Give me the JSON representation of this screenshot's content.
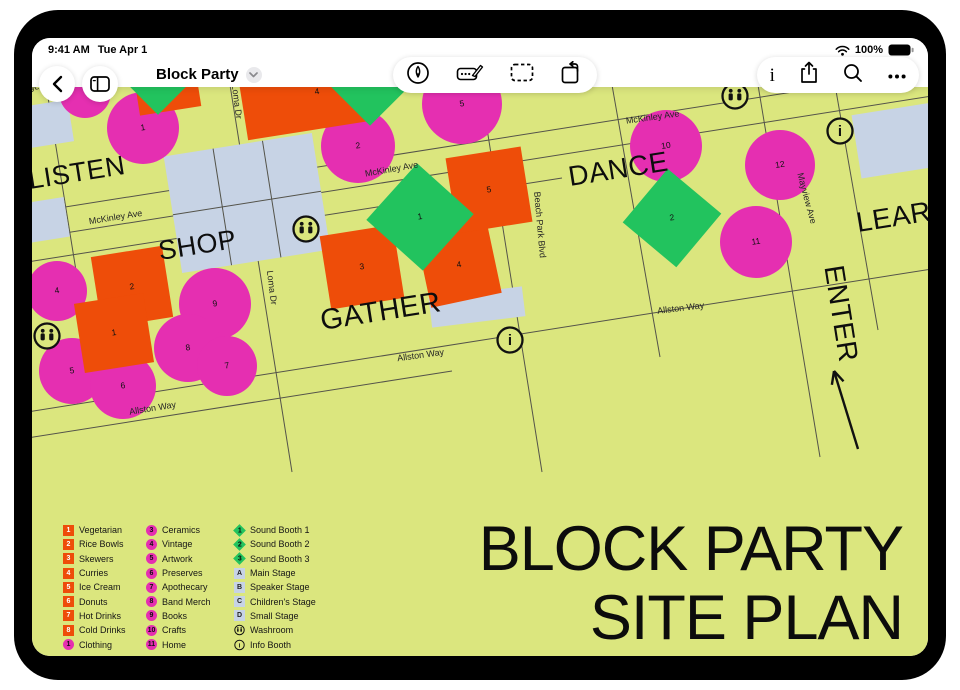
{
  "status": {
    "time": "9:41 AM",
    "date": "Tue Apr 1",
    "battery": "100%"
  },
  "toolbar": {
    "title": "Block Party",
    "left_icons": [
      "back-chevron",
      "boards-sidebar"
    ],
    "center_icons": [
      "pencil-tool",
      "marker-tool",
      "select-tool",
      "shape-rotate-tool"
    ],
    "right_icons": [
      "info",
      "share",
      "search",
      "more"
    ]
  },
  "map": {
    "colors": {
      "bg": "#dbe67e",
      "pink": "#e52fb1",
      "orange": "#ee4d09",
      "green": "#22c35e",
      "stage": "#c7d3e5",
      "line": "#54534a",
      "ink": "#111111"
    },
    "poster": {
      "l1": "BLOCK PARTY",
      "l2": "SITE PLAN"
    },
    "lines": [
      [
        -5,
        126,
        900,
        -17
      ],
      [
        -5,
        152,
        900,
        9
      ],
      [
        -5,
        175,
        530,
        91
      ],
      [
        -5,
        325,
        900,
        182
      ],
      [
        -5,
        351,
        420,
        284
      ],
      [
        14,
        -2,
        62,
        295
      ],
      [
        198,
        -2,
        260,
        385
      ],
      [
        448,
        -2,
        510,
        385
      ],
      [
        580,
        -2,
        628,
        270
      ],
      [
        726,
        -2,
        788,
        370
      ],
      [
        803,
        -2,
        846,
        243
      ]
    ],
    "stages": [
      {
        "x": 215,
        "y": 116,
        "w": 150,
        "h": 118,
        "rot": -9,
        "grid": true,
        "label": "Stage A",
        "lx": 221,
        "ly": 108,
        "lrot": -9
      },
      {
        "x": 445,
        "y": 220,
        "w": 94,
        "h": 30,
        "rot": -7,
        "label": "Stage C",
        "lx": 445,
        "ly": 223,
        "lrot": -7
      },
      {
        "x": 868,
        "y": 53,
        "w": 88,
        "h": 64,
        "rot": -9,
        "label": "S",
        "lx": 888,
        "ly": 45,
        "lrot": -9
      },
      {
        "x": 16,
        "y": 37,
        "w": 46,
        "h": 42,
        "rot": -9
      },
      {
        "x": 14,
        "y": 133,
        "w": 42,
        "h": 40,
        "rot": -9
      }
    ],
    "zones": [
      {
        "t": "LISTEN",
        "x": -2,
        "y": 102,
        "rot": -9,
        "s": 27,
        "anchor": "start"
      },
      {
        "t": "SHOP",
        "x": 128,
        "y": 173,
        "rot": -9,
        "s": 27,
        "anchor": "start"
      },
      {
        "t": "GATHER",
        "x": 290,
        "y": 243,
        "rot": -9,
        "s": 29,
        "anchor": "start"
      },
      {
        "t": "DANCE",
        "x": 538,
        "y": 99,
        "rot": -9,
        "s": 28,
        "anchor": "start"
      },
      {
        "t": "LEARN",
        "x": 826,
        "y": 145,
        "rot": -9,
        "s": 28,
        "anchor": "start"
      },
      {
        "t": "ENTER",
        "x": 800,
        "y": 228,
        "rot": 81,
        "s": 28,
        "anchor": "middle"
      }
    ],
    "street_labels": [
      {
        "t": "McKinley Ave",
        "x": 84,
        "y": 133,
        "rot": -9
      },
      {
        "t": "McKinley Ave",
        "x": 360,
        "y": 85,
        "rot": -10
      },
      {
        "t": "McKinley Ave",
        "x": 621,
        "y": 33,
        "rot": -8
      },
      {
        "t": "Loma Dr",
        "x": 202,
        "y": 15,
        "rot": 83
      },
      {
        "t": "Loma Dr",
        "x": 237,
        "y": 201,
        "rot": 83
      },
      {
        "t": "Beach Park Blvd",
        "x": 505,
        "y": 138,
        "rot": 85
      },
      {
        "t": "Mayview Ave",
        "x": 772,
        "y": 112,
        "rot": 75
      },
      {
        "t": "Allston Way",
        "x": 121,
        "y": 324,
        "rot": -9
      },
      {
        "t": "Allston Way",
        "x": 389,
        "y": 271,
        "rot": -8
      },
      {
        "t": "Allston Way",
        "x": 649,
        "y": 224,
        "rot": -7
      }
    ],
    "shapes": [
      {
        "k": "circle",
        "x": 53,
        "y": 5,
        "r": 26,
        "n": ""
      },
      {
        "k": "circle",
        "x": 111,
        "y": 41,
        "r": 36,
        "n": "1"
      },
      {
        "k": "circle",
        "x": 326,
        "y": 59,
        "r": 37,
        "n": "2"
      },
      {
        "k": "circle",
        "x": 430,
        "y": 17,
        "r": 40,
        "n": "5"
      },
      {
        "k": "circle",
        "x": 25,
        "y": 204,
        "r": 30,
        "n": "4"
      },
      {
        "k": "circle",
        "x": 40,
        "y": 284,
        "r": 33,
        "n": "5"
      },
      {
        "k": "circle",
        "x": 91,
        "y": 299,
        "r": 33,
        "n": "6"
      },
      {
        "k": "circle",
        "x": 183,
        "y": 217,
        "r": 36,
        "n": "9"
      },
      {
        "k": "circle",
        "x": 156,
        "y": 261,
        "r": 34,
        "n": "8"
      },
      {
        "k": "circle",
        "x": 195,
        "y": 279,
        "r": 30,
        "n": "7"
      },
      {
        "k": "circle",
        "x": 634,
        "y": 59,
        "r": 36,
        "n": "10"
      },
      {
        "k": "circle",
        "x": 748,
        "y": 78,
        "r": 35,
        "n": "12"
      },
      {
        "k": "circle",
        "x": 724,
        "y": 155,
        "r": 36,
        "n": "11"
      },
      {
        "k": "sq",
        "x": 136,
        "y": 7,
        "w": 62,
        "h": 34,
        "rot": -9,
        "n": ""
      },
      {
        "k": "sq",
        "x": 272,
        "y": 16,
        "w": 122,
        "h": 56,
        "rot": -9,
        "n": "4",
        "nx": 285,
        "ny": 5
      },
      {
        "k": "sq",
        "x": 100,
        "y": 200,
        "w": 72,
        "h": 72,
        "rot": -9,
        "n": "2"
      },
      {
        "k": "sq",
        "x": 82,
        "y": 246,
        "w": 70,
        "h": 70,
        "rot": -9,
        "n": "1"
      },
      {
        "k": "sq",
        "x": 330,
        "y": 180,
        "w": 74,
        "h": 74,
        "rot": -9,
        "n": "3"
      },
      {
        "k": "sq",
        "x": 427,
        "y": 178,
        "w": 72,
        "h": 72,
        "rot": -12,
        "n": "4"
      },
      {
        "k": "sq",
        "x": 457,
        "y": 103,
        "w": 76,
        "h": 76,
        "rot": -9,
        "n": "5"
      },
      {
        "k": "dia",
        "x": 388,
        "y": 130,
        "w": 76,
        "h": 76,
        "rot": 42,
        "n": "1"
      },
      {
        "k": "dia",
        "x": 640,
        "y": 131,
        "w": 70,
        "h": 70,
        "rot": 40,
        "n": "2"
      },
      {
        "k": "dia",
        "x": 126,
        "y": -16,
        "w": 62,
        "h": 62,
        "rot": 45,
        "n": ""
      },
      {
        "k": "dia",
        "x": 338,
        "y": -22,
        "w": 86,
        "h": 86,
        "rot": 45,
        "n": ""
      }
    ],
    "icons": [
      {
        "k": "wash",
        "x": 15,
        "y": 249
      },
      {
        "k": "wash",
        "x": 274,
        "y": 142
      },
      {
        "k": "wash",
        "x": 703,
        "y": 9
      },
      {
        "k": "info",
        "x": 478,
        "y": 253
      },
      {
        "k": "info",
        "x": 808,
        "y": 44
      }
    ],
    "arrow": {
      "x1": 826,
      "y1": 362,
      "x2": 802,
      "y2": 284
    }
  },
  "legend": {
    "columns": [
      [
        {
          "b": "sq",
          "n": "1",
          "label": "Vegetarian"
        },
        {
          "b": "sq",
          "n": "2",
          "label": "Rice Bowls"
        },
        {
          "b": "sq",
          "n": "3",
          "label": "Skewers"
        },
        {
          "b": "sq",
          "n": "4",
          "label": "Curries"
        },
        {
          "b": "sq",
          "n": "5",
          "label": "Ice Cream"
        },
        {
          "b": "sq",
          "n": "6",
          "label": "Donuts"
        },
        {
          "b": "sq",
          "n": "7",
          "label": "Hot Drinks"
        },
        {
          "b": "sq",
          "n": "8",
          "label": "Cold Drinks"
        },
        {
          "b": "circ",
          "n": "1",
          "label": "Clothing"
        }
      ],
      [
        {
          "b": "circ",
          "n": "3",
          "label": "Ceramics"
        },
        {
          "b": "circ",
          "n": "4",
          "label": "Vintage"
        },
        {
          "b": "circ",
          "n": "5",
          "label": "Artwork"
        },
        {
          "b": "circ",
          "n": "6",
          "label": "Preserves"
        },
        {
          "b": "circ",
          "n": "7",
          "label": "Apothecary"
        },
        {
          "b": "circ",
          "n": "8",
          "label": "Band Merch"
        },
        {
          "b": "circ",
          "n": "9",
          "label": "Books"
        },
        {
          "b": "circ",
          "n": "10",
          "label": "Crafts"
        },
        {
          "b": "circ",
          "n": "11",
          "label": "Home"
        }
      ],
      [
        {
          "b": "dia",
          "n": "1",
          "label": "Sound Booth 1"
        },
        {
          "b": "dia",
          "n": "2",
          "label": "Sound Booth 2"
        },
        {
          "b": "dia",
          "n": "3",
          "label": "Sound Booth 3"
        },
        {
          "b": "stage",
          "n": "A",
          "label": "Main Stage"
        },
        {
          "b": "stage",
          "n": "B",
          "label": "Speaker Stage"
        },
        {
          "b": "stage",
          "n": "C",
          "label": "Children's Stage"
        },
        {
          "b": "stage",
          "n": "D",
          "label": "Small Stage"
        },
        {
          "b": "wash",
          "n": "",
          "label": "Washroom"
        },
        {
          "b": "info",
          "n": "",
          "label": "Info Booth"
        }
      ]
    ],
    "col_lefts": [
      31,
      114,
      202
    ]
  }
}
